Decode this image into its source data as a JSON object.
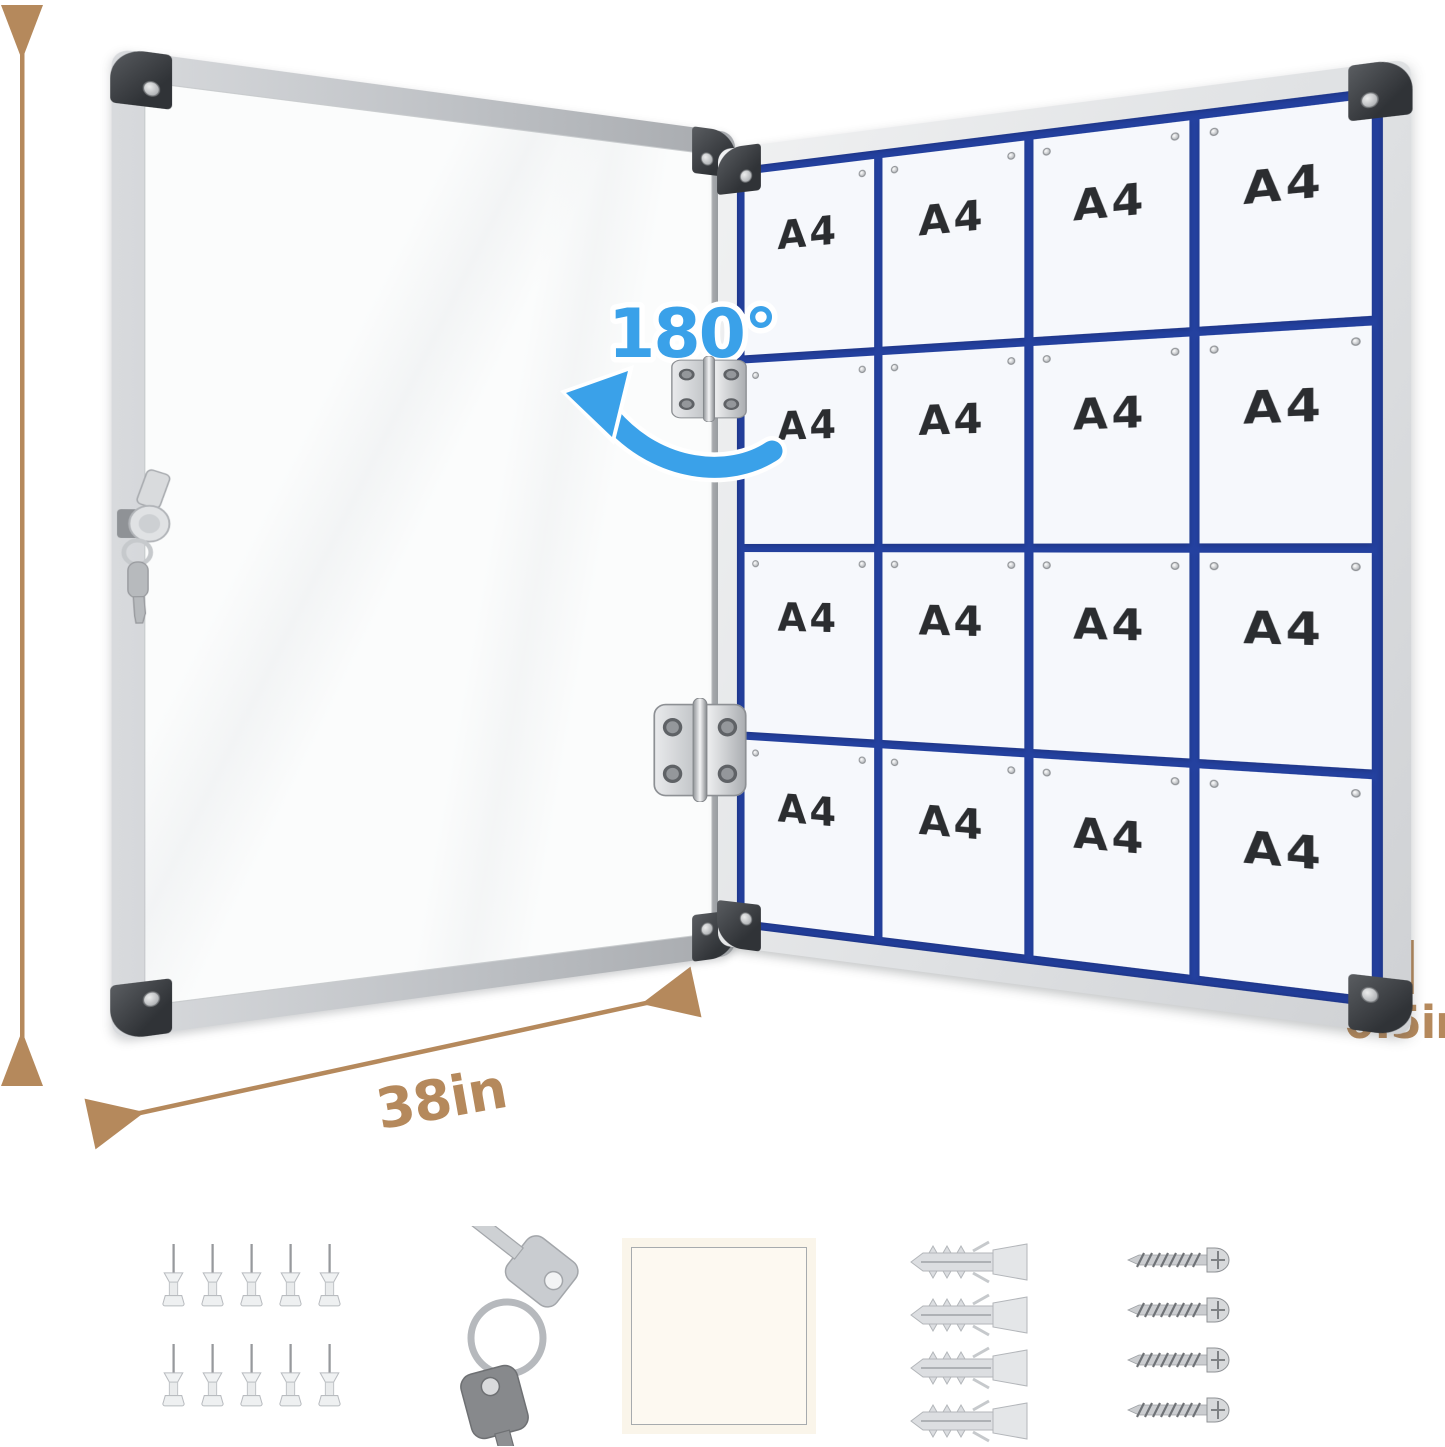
{
  "dimensions": {
    "height_label": "38in",
    "width_label": "38in",
    "thickness_label": "0.5in",
    "open_angle_label": "180°"
  },
  "board": {
    "grid_rows": 4,
    "grid_cols": 4,
    "paper_labels": [
      "A4",
      "A4",
      "A4",
      "A4",
      "A4",
      "A4",
      "A4",
      "A4",
      "A4",
      "A4",
      "A4",
      "A4",
      "A4",
      "A4",
      "A4",
      "A4"
    ]
  },
  "accessories": {
    "pushpins": {
      "icon": "pushpin-icon",
      "count": 10
    },
    "keys": {
      "icon": "key-icon",
      "count": 2
    },
    "adhesive_pad": {
      "icon": "adhesive-pad-icon",
      "count": 1
    },
    "wall_anchors": {
      "icon": "wall-anchor-icon",
      "count": 4
    },
    "screws": {
      "icon": "screw-icon",
      "count": 4
    }
  },
  "colors": {
    "dimension_text": "#b5895c",
    "angle_text": "#3aa1e9",
    "grid_line": "#24419f",
    "frame_silver": "#c9ccd0"
  }
}
